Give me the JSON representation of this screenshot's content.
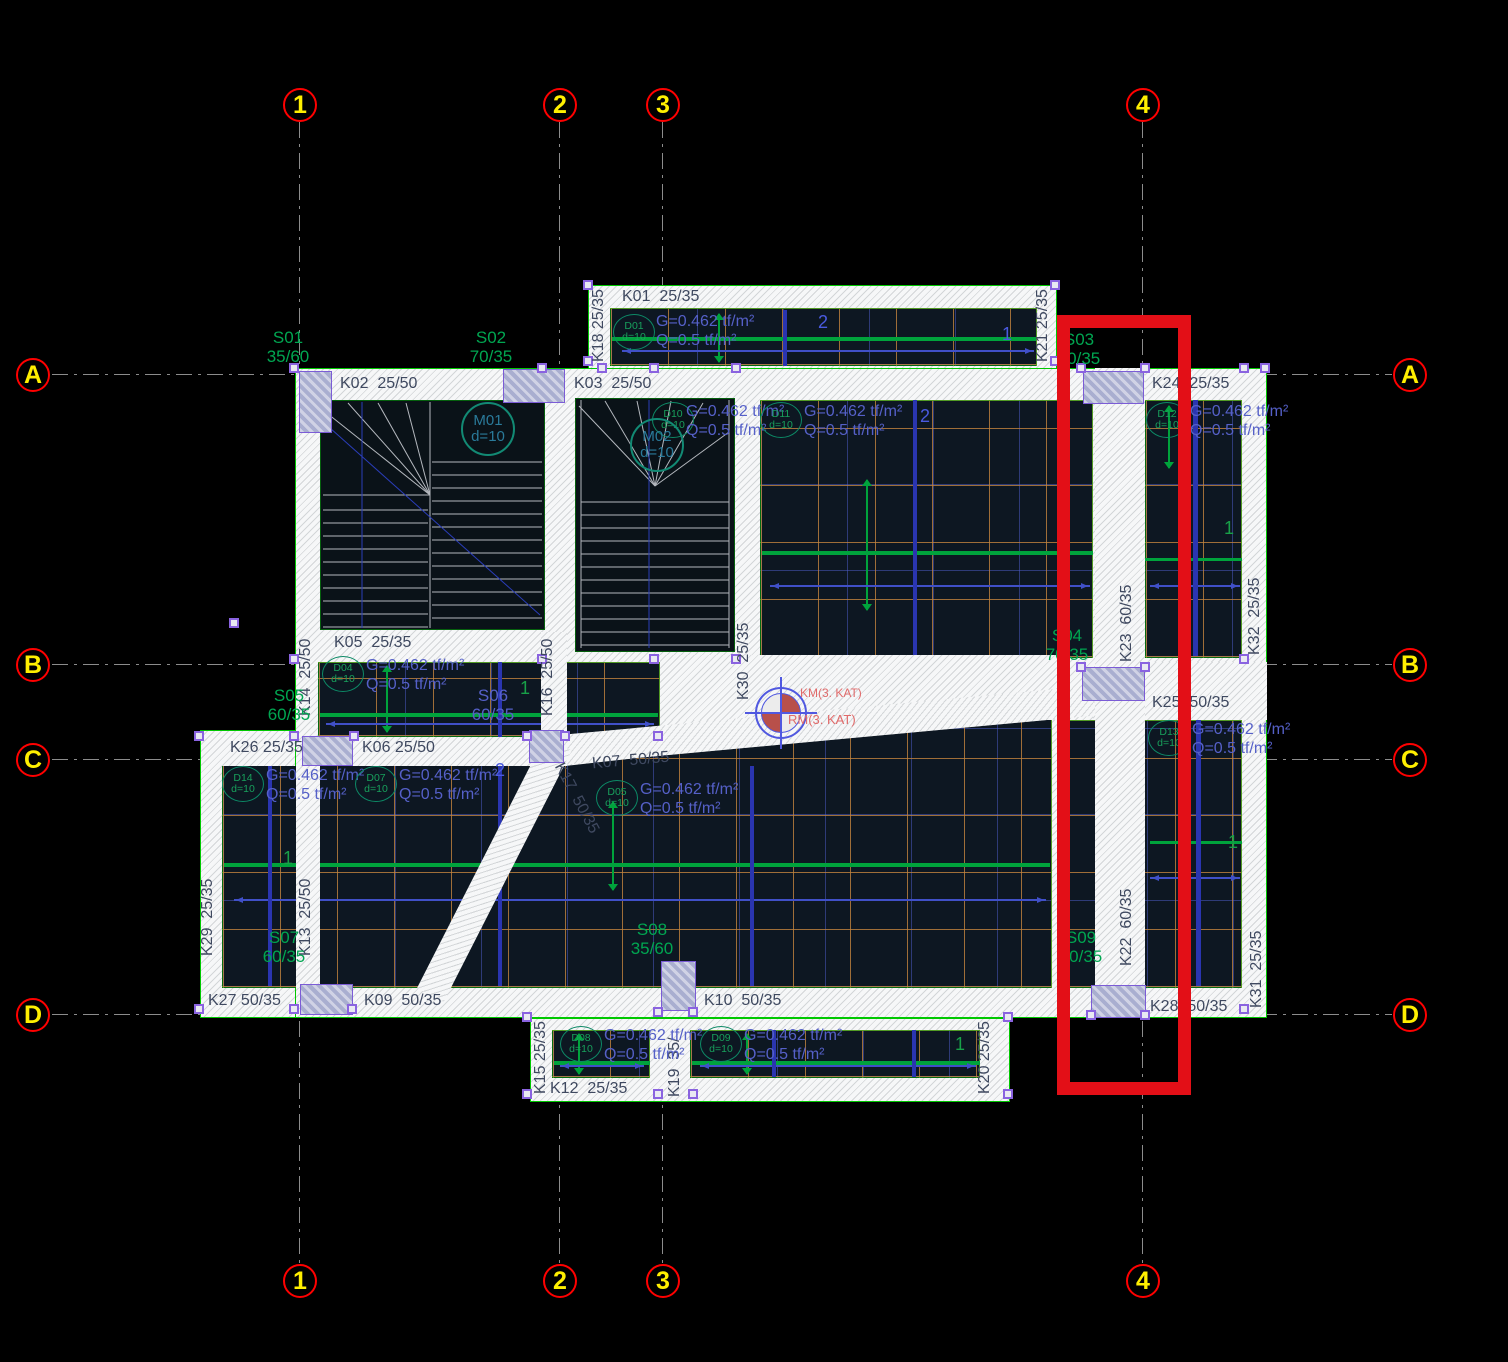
{
  "axes": {
    "cols": [
      "1",
      "2",
      "3",
      "4"
    ],
    "rows": [
      "A",
      "B",
      "C",
      "D"
    ]
  },
  "beams": {
    "k01": "K01  25/35",
    "k02": "K02  25/50",
    "k03": "K03  25/50",
    "k05": "K05  25/35",
    "k06": "K06 25/50",
    "k07": "K07  50/35",
    "k09": "K09  50/35",
    "k10": "K10  50/35",
    "k12": "K12  25/35",
    "k13": "K13  25/50",
    "k14": "K14  25/50",
    "k15": "K15 25/35",
    "k16": "K16  25/50",
    "k17": "K17  50/35",
    "k18": "K18 25/35",
    "k19": "K19  35/",
    "k20": "K20 25/35",
    "k21": "K21 25/35",
    "k22": "K22  60/35",
    "k23": "K23  60/35",
    "k24": "K24  25/35",
    "k25": "K25  50/35",
    "k26": "K26 25/35",
    "k27": "K27 50/35",
    "k28": "K28  50/35",
    "k29": "K29  25/35",
    "k30": "K30  25/35",
    "k31": "K31  25/35",
    "k32": "K32  25/35"
  },
  "slabs": {
    "s01": {
      "name": "S01",
      "dim": "35/60"
    },
    "s02": {
      "name": "S02",
      "dim": "70/35"
    },
    "s03": {
      "name": "S03",
      "dim": "70/35"
    },
    "s04": {
      "name": "S04",
      "dim": "70/35"
    },
    "s05": {
      "name": "S05",
      "dim": "60/35"
    },
    "s06": {
      "name": "S06",
      "dim": "60/35"
    },
    "s07": {
      "name": "S07",
      "dim": "60/35"
    },
    "s08": {
      "name": "S08",
      "dim": "35/60"
    },
    "s09": {
      "name": "S09",
      "dim": "50/35"
    }
  },
  "loads": {
    "g": "G=0.462 tf/m²",
    "q": "Q=0.5 tf/m²",
    "d": "d=10"
  },
  "drops": {
    "d01": "D01",
    "d04": "D04",
    "d05": "D05",
    "d07": "D07",
    "d08": "D08",
    "d09": "D09",
    "d10": "D10",
    "d11": "D11",
    "d12": "D12",
    "d13": "D13",
    "d14": "D14"
  },
  "markers": {
    "m01": "M01",
    "m02": "M02",
    "km": "KM(3. KAT)",
    "rm": "RM(3. KAT)"
  },
  "span_marks": {
    "one": "1",
    "two": "2"
  },
  "colors": {
    "highlight": "#e30f17",
    "axis_circle": "#ff0000",
    "axis_label": "#ffff00",
    "slab_label": "#00a651",
    "load_text": "#5560c8",
    "beam_text": "#3f4960",
    "rib_green": "#00a33c",
    "grid_orange": "#c3843e",
    "grid_blue": "#5058e0"
  }
}
